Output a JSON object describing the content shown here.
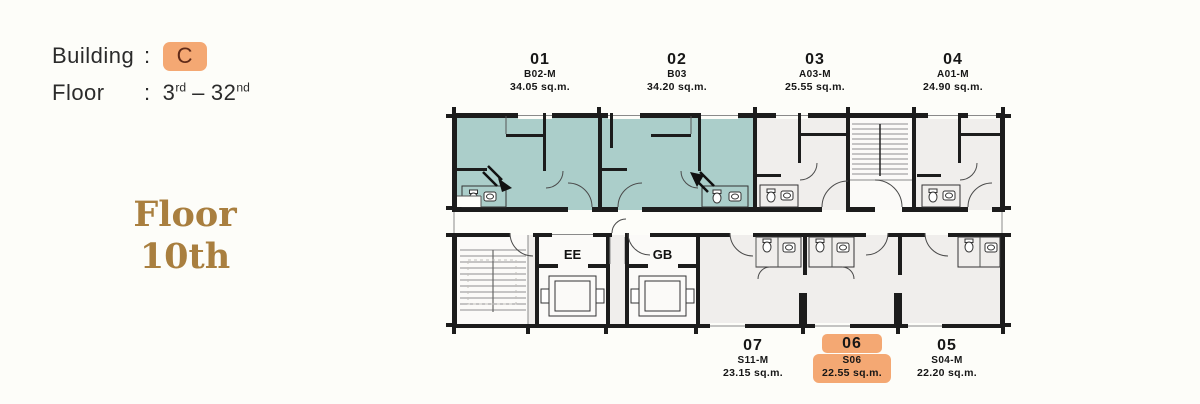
{
  "header": {
    "building_label": "Building",
    "building_colon": ":",
    "building_value": "C",
    "floor_label": "Floor",
    "floor_colon": ":",
    "floor_range": {
      "start_num": "3",
      "start_suffix": "rd",
      "separator": "–",
      "end_num": "32",
      "end_suffix": "nd"
    }
  },
  "floor_callout": {
    "line1": "Floor",
    "line2": "10th"
  },
  "plan": {
    "top_units": [
      {
        "number": "01",
        "code": "B02-M",
        "area": "34.05 sq.m.",
        "highlighted": false,
        "color_fill": "teal"
      },
      {
        "number": "02",
        "code": "B03",
        "area": "34.20 sq.m.",
        "highlighted": false,
        "color_fill": "teal"
      },
      {
        "number": "03",
        "code": "A03-M",
        "area": "25.55 sq.m.",
        "highlighted": false,
        "color_fill": "none"
      },
      {
        "number": "04",
        "code": "A01-M",
        "area": "24.90 sq.m.",
        "highlighted": false,
        "color_fill": "none"
      }
    ],
    "bottom_units": [
      {
        "number": "07",
        "code": "S11-M",
        "area": "23.15 sq.m.",
        "highlighted": false,
        "color_fill": "none"
      },
      {
        "number": "06",
        "code": "S06",
        "area": "22.55 sq.m.",
        "highlighted": true,
        "color_fill": "none"
      },
      {
        "number": "05",
        "code": "S04-M",
        "area": "22.20 sq.m.",
        "highlighted": false,
        "color_fill": "none"
      }
    ],
    "elevators": [
      {
        "label": "EE"
      },
      {
        "label": "GB"
      }
    ]
  },
  "colors": {
    "teal": "#abceca",
    "hl": "#f4a873",
    "brown": "#a97f3f"
  }
}
